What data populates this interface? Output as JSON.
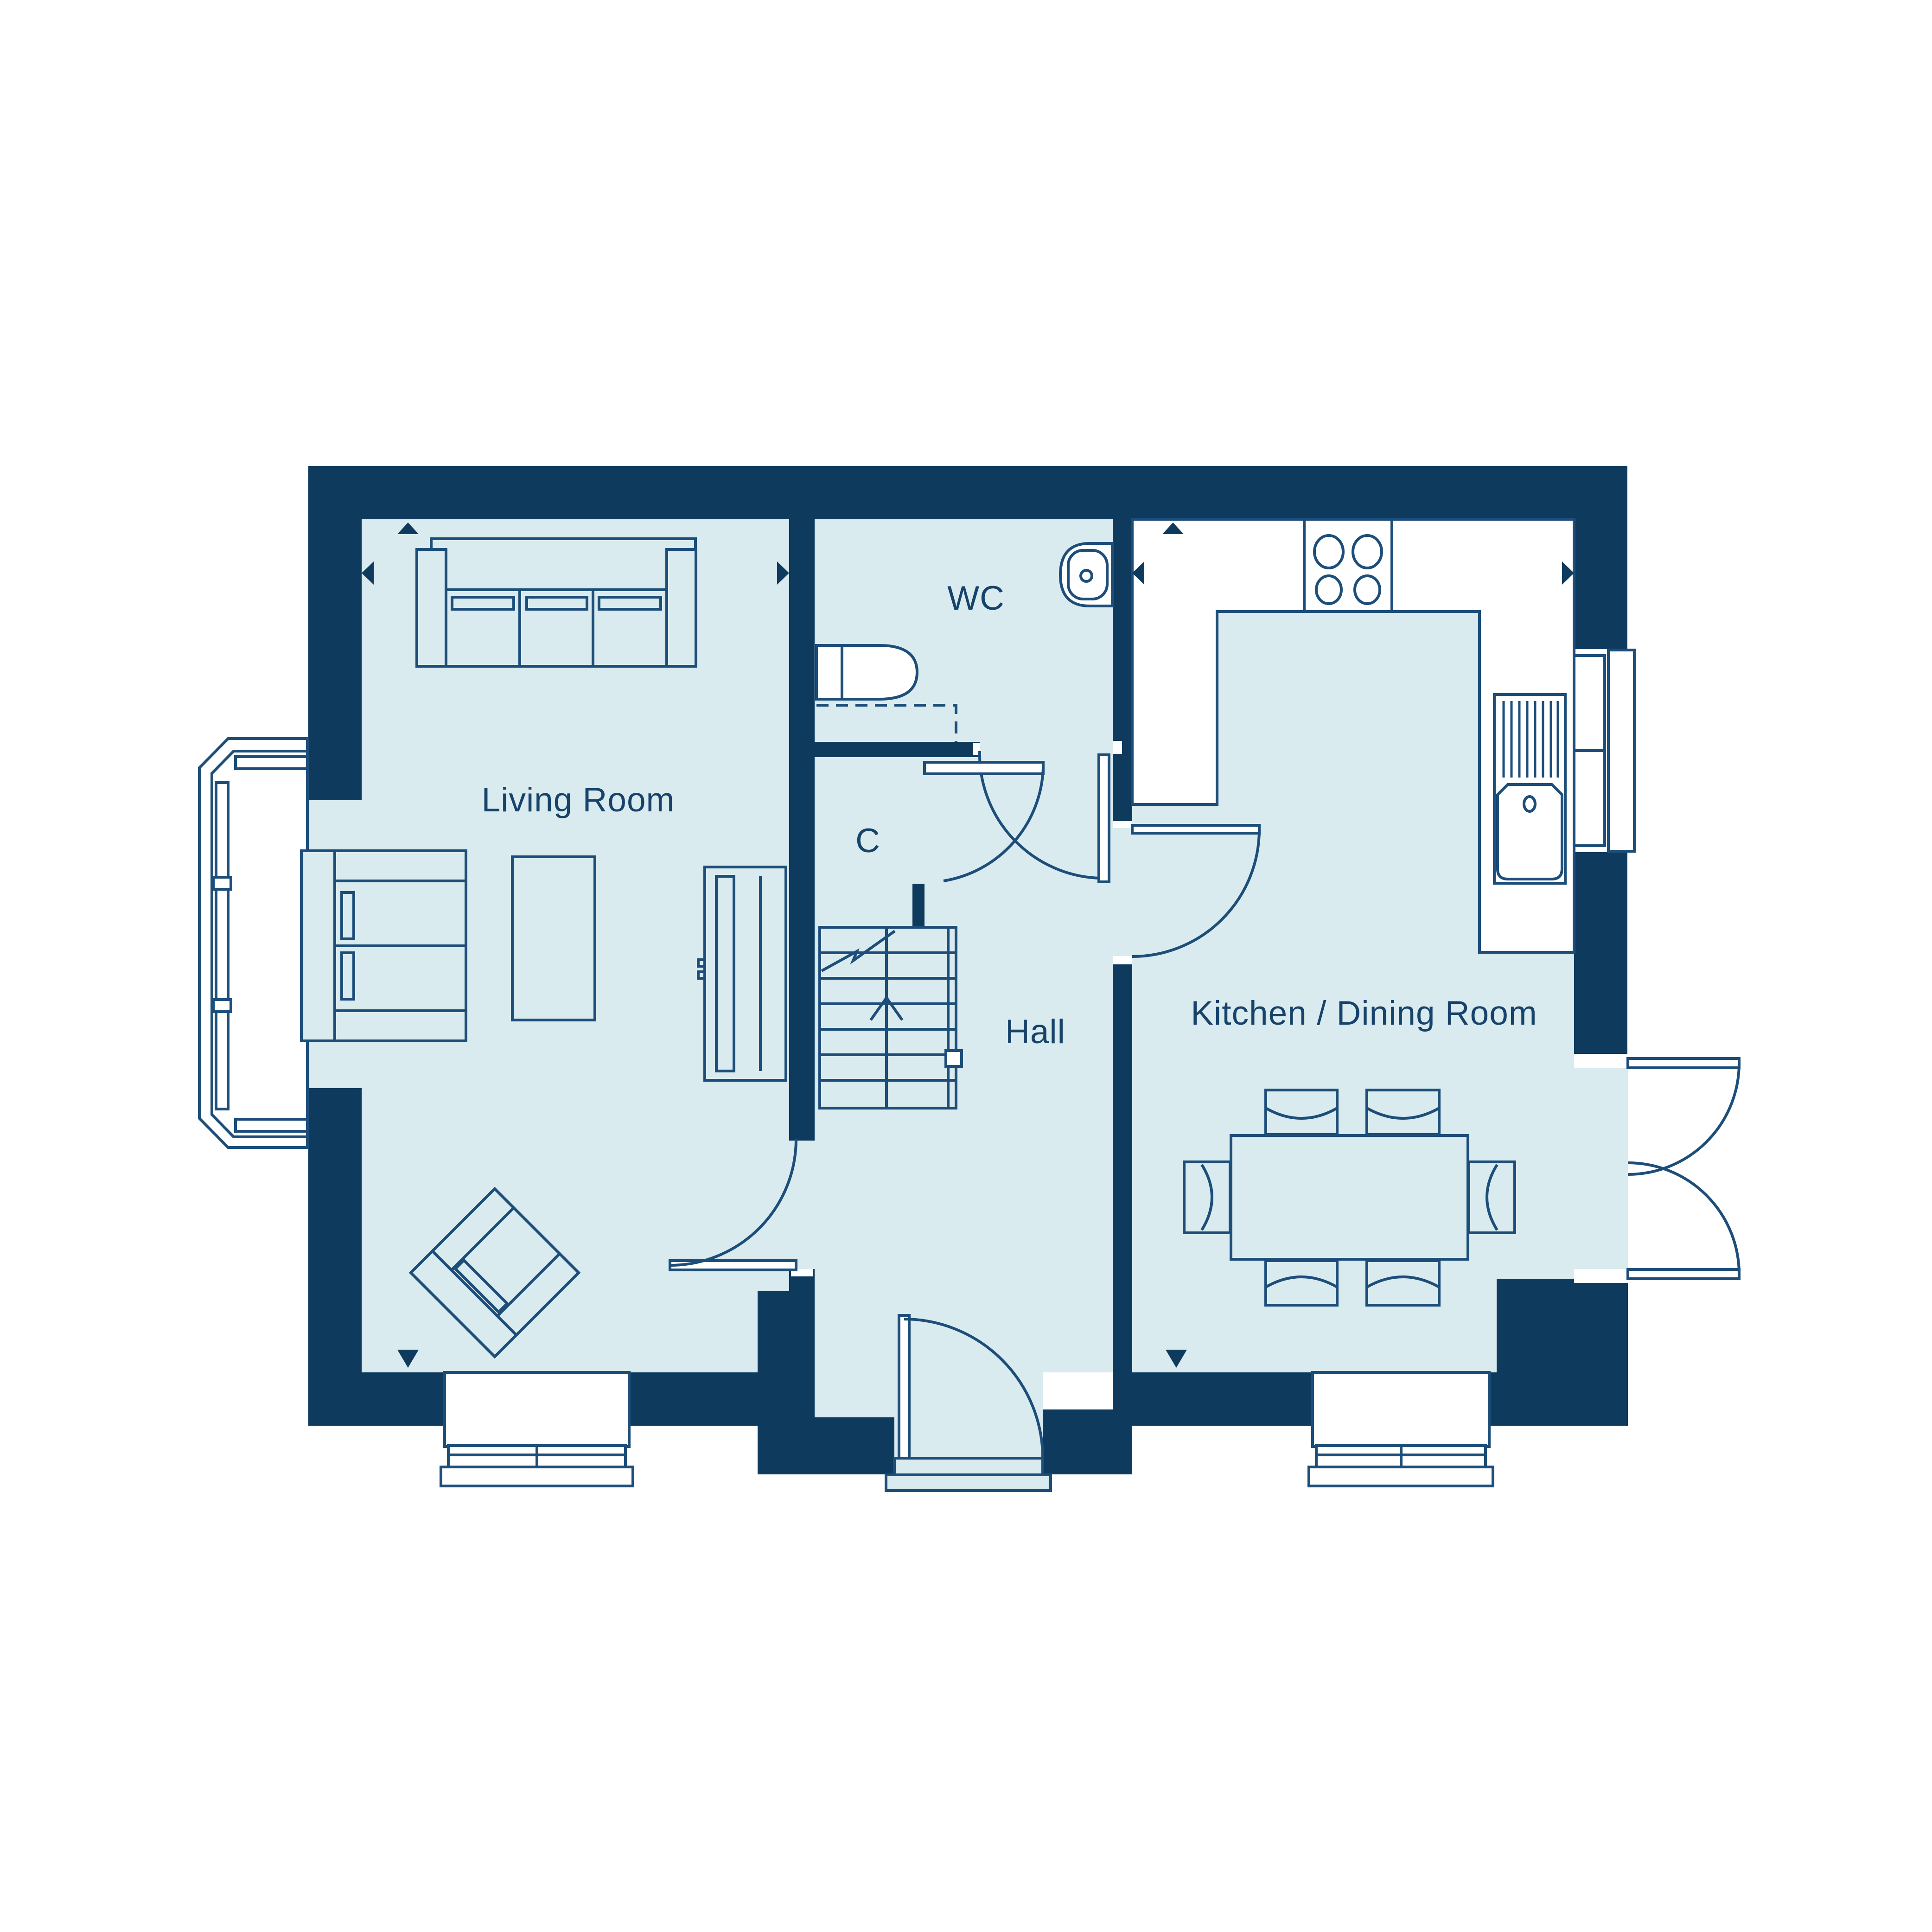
{
  "floorplan": {
    "colors": {
      "wall": "#0e3a5e",
      "floor": "#d9ebee",
      "line": "#1d4e7a",
      "text": "#17436b",
      "white": "#ffffff"
    },
    "rooms": {
      "living": {
        "label": "Living Room"
      },
      "wc": {
        "label": "WC"
      },
      "cupboard": {
        "label": "C"
      },
      "hall": {
        "label": "Hall"
      },
      "kitchen": {
        "label": "Kitchen / Dining Room"
      }
    }
  }
}
